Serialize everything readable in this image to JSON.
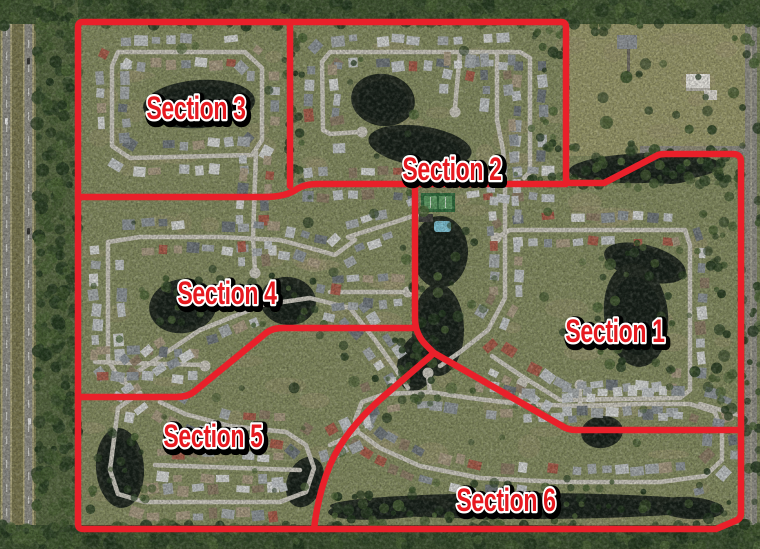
{
  "sections": [
    {
      "label": "Section 1"
    },
    {
      "label": "Section 2"
    },
    {
      "label": "Section 3"
    },
    {
      "label": "Section 4"
    },
    {
      "label": "Section 5"
    },
    {
      "label": "Section 6"
    }
  ],
  "overlay": {
    "line_color": "#e9202a",
    "label_color": "#e6191f",
    "label_outline_inner": "#ffffff",
    "label_outline_outer": "#000000"
  }
}
